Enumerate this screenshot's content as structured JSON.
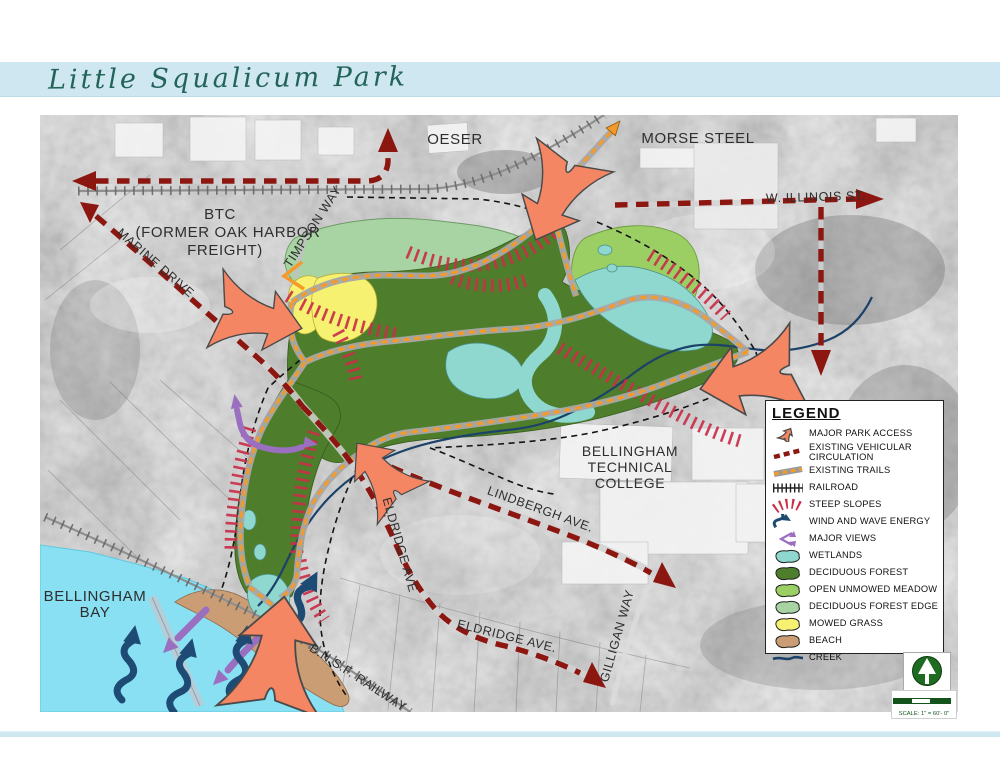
{
  "page": {
    "title": "Little Squalicum Park"
  },
  "map_labels": {
    "oeser": "OESER",
    "morse_steel": "MORSE STEEL",
    "w_illinois": "W. ILLINOIS ST.",
    "btc_line1": "BTC",
    "btc_line2": "(FORMER OAK HARBOR",
    "btc_line3": "FREIGHT)",
    "timpson_way": "TIMPSON WAY",
    "marine_drive": "MARINE DRIVE",
    "bellingham_tech_1": "BELLINGHAM",
    "bellingham_tech_2": "TECHNICAL",
    "bellingham_tech_3": "COLLEGE",
    "lindbergh_ave": "LINDBERGH AVE.",
    "eldridge_ave_upper": "ELDRIDGE AVE",
    "eldridge_ave_lower": "ELDRIDGE AVE.",
    "gilligan_way": "GILLIGAN WAY",
    "bnsf_railway": "B.N.S.F. RAILWAY",
    "bellingham_bay_1": "BELLINGHAM",
    "bellingham_bay_2": "BAY"
  },
  "legend": {
    "title": "LEGEND",
    "items": [
      {
        "label": "MAJOR PARK ACCESS",
        "symbol": "park-access-arrow",
        "color": "#f58663"
      },
      {
        "label": "EXISTING VEHICULAR CIRCULATION",
        "symbol": "red-dashed-line",
        "color": "#8c1710"
      },
      {
        "label": "EXISTING TRAILS",
        "symbol": "orange-dashed-line",
        "color": "#f39a2b"
      },
      {
        "label": "RAILROAD",
        "symbol": "cross-tie-line",
        "color": "#333333"
      },
      {
        "label": "STEEP SLOPES",
        "symbol": "red-hatch",
        "color": "#c92f49"
      },
      {
        "label": "WIND AND WAVE ENERGY",
        "symbol": "wave-arrow",
        "color": "#1d4b74"
      },
      {
        "label": "MAJOR VIEWS",
        "symbol": "view-arrows",
        "color": "#9a6fc0"
      },
      {
        "label": "WETLANDS",
        "symbol": "area-blob",
        "color": "#8fd8cf"
      },
      {
        "label": "DECIDUOUS FOREST",
        "symbol": "area-blob",
        "color": "#4e7d2b"
      },
      {
        "label": "OPEN UNMOWED MEADOW",
        "symbol": "area-blob",
        "color": "#9ccf63"
      },
      {
        "label": "DECIDUOUS FOREST EDGE",
        "symbol": "area-blob",
        "color": "#a8d3a2"
      },
      {
        "label": "MOWED GRASS",
        "symbol": "area-blob",
        "color": "#f6f170"
      },
      {
        "label": "BEACH",
        "symbol": "area-blob",
        "color": "#cb9d74"
      },
      {
        "label": "CREEK",
        "symbol": "creek-line",
        "color": "#1c4269"
      }
    ]
  },
  "scale": {
    "text": "SCALE: 1\" = 60'- 0\""
  },
  "colors": {
    "banner_blue": "#cfe7f0",
    "title_green": "#23645a",
    "road_red": "#8c1710",
    "trail_orange": "#f39a2b",
    "park_access_orange": "#f58663",
    "steep_slope_red": "#c92f49",
    "wind_wave_blue": "#1d4b74",
    "major_views_purple": "#9a6fc0",
    "wetland_teal": "#8fd8cf",
    "deciduous_forest_green": "#4e7d2b",
    "open_meadow_green": "#9ccf63",
    "forest_edge_sage": "#a8d3a2",
    "mowed_grass_yellow": "#f6f170",
    "beach_tan": "#cb9d74",
    "creek_blue": "#1c4269",
    "bay_cyan": "#89e0f3"
  }
}
